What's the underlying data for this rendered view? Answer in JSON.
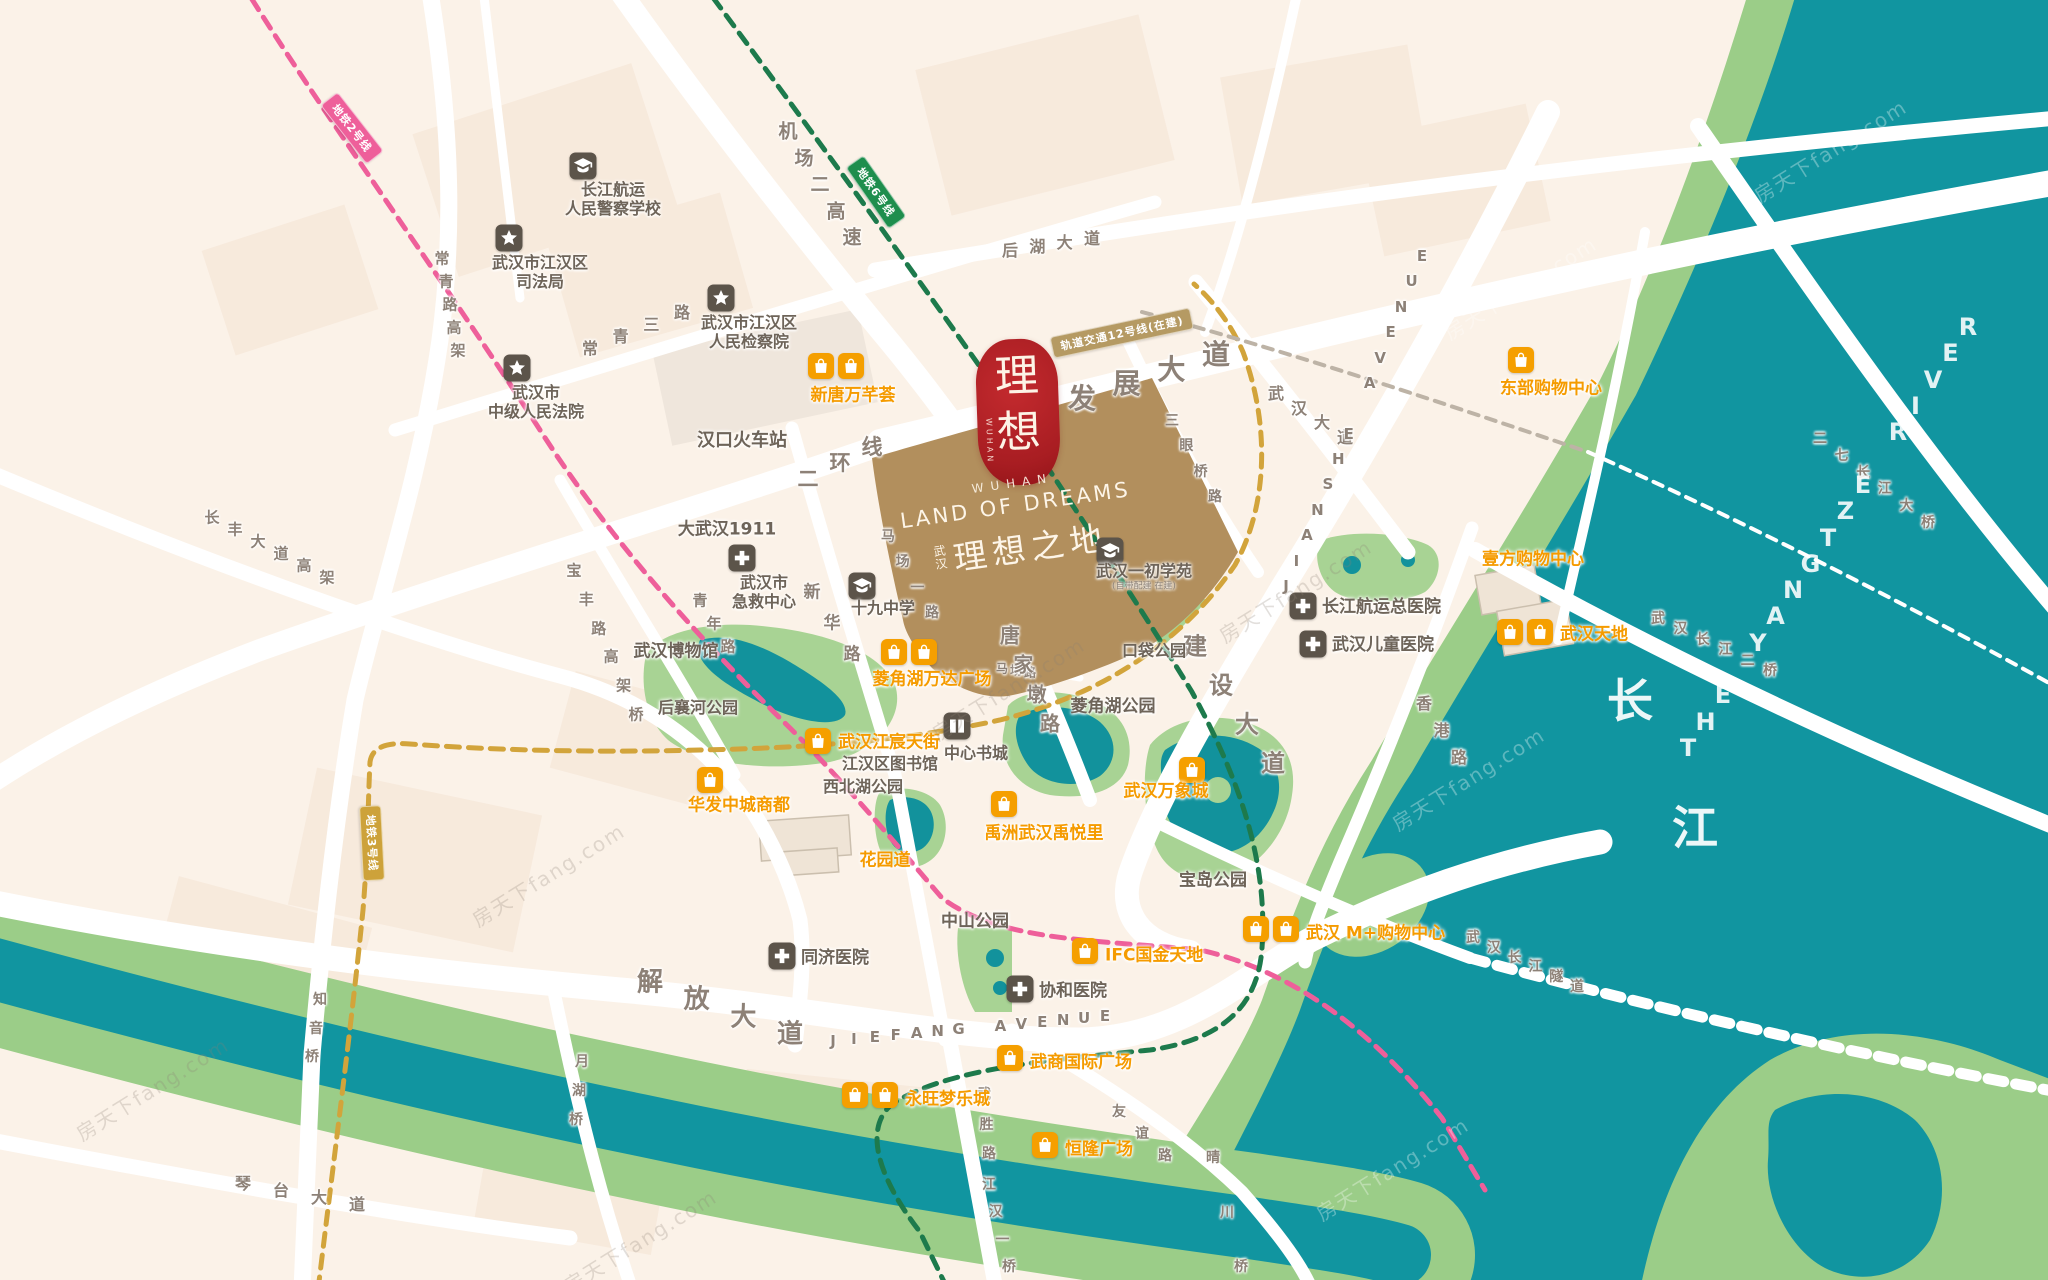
{
  "meta": {
    "title": "武汉理想之地 区位图",
    "width": 2048,
    "height": 1280
  },
  "colors": {
    "bg": "#fbf2e8",
    "water": "#1195a0",
    "bank": "#9bcd88",
    "park": "#a8d394",
    "road": "#ffffff",
    "project": "#b28f5d",
    "seal_red": "#a81d22",
    "orange": "#f59f00",
    "poi_gray": "#5c544a",
    "metro2_pink": "#ee5f9a",
    "metro3_gold": "#cda23a",
    "metro6_green": "#1e8e4d",
    "metro12_tan": "#b59a63"
  },
  "project": {
    "seal_top": "理",
    "seal_bottom": "想",
    "seal_side": "WUHAN",
    "en_small": "WUHAN",
    "en_title": "LAND OF DREAMS",
    "cn_prefix_1": "武",
    "cn_prefix_2": "汉",
    "cn_title": "理想之地"
  },
  "watermark_text": "房天下fang.com",
  "spread_labels": [
    [
      "机场二高速",
      788,
      130,
      852,
      236,
      19
    ],
    [
      "常青三路",
      590,
      347,
      682,
      311,
      16
    ],
    [
      "常青路高架",
      442,
      258,
      458,
      350,
      15
    ],
    [
      "长丰大道高架",
      212,
      517,
      327,
      577,
      15
    ],
    [
      "宝丰路高架桥",
      574,
      570,
      636,
      714,
      15
    ],
    [
      "青年路",
      700,
      600,
      728,
      646,
      15
    ],
    [
      "新华路",
      812,
      590,
      852,
      652,
      17
    ],
    [
      "马场一路",
      888,
      536,
      932,
      612,
      14
    ],
    [
      "马场路",
      1002,
      668,
      1030,
      672,
      12
    ],
    [
      "二环线",
      808,
      478,
      872,
      446,
      21
    ],
    [
      "发展大道",
      1082,
      397,
      1216,
      353,
      28
    ],
    [
      "后湖大道",
      1010,
      249,
      1092,
      237,
      16
    ],
    [
      "三眼桥路",
      1172,
      420,
      1215,
      496,
      14
    ],
    [
      "武汉大道",
      1276,
      392,
      1345,
      436,
      16
    ],
    [
      "建设大道",
      1195,
      644,
      1273,
      761,
      24
    ],
    [
      "香港路",
      1424,
      702,
      1459,
      756,
      16
    ],
    [
      "唐家墩路",
      1010,
      634,
      1050,
      722,
      20
    ],
    [
      "解放大道",
      650,
      980,
      790,
      1032,
      26
    ],
    [
      "JIEFANG AVENUE",
      833,
      1041,
      1105,
      1016,
      15
    ],
    [
      "JIANSHE AVENUE",
      1286,
      586,
      1422,
      256,
      15
    ],
    [
      "琴台大道",
      243,
      1182,
      357,
      1203,
      16
    ],
    [
      "武胜路",
      984,
      1094,
      989,
      1153,
      14
    ],
    [
      "江汉一桥",
      989,
      1184,
      1009,
      1266,
      14
    ],
    [
      "月湖桥",
      582,
      1061,
      576,
      1119,
      14
    ],
    [
      "知音桥",
      320,
      999,
      312,
      1056,
      14
    ],
    [
      "友谊路",
      1119,
      1111,
      1165,
      1155,
      14
    ],
    [
      "晴川桥",
      1213,
      1157,
      1241,
      1266,
      14
    ],
    [
      "二七长江大桥",
      1820,
      438,
      1928,
      522,
      14
    ],
    [
      "武汉长江二桥",
      1658,
      618,
      1770,
      670,
      14
    ],
    [
      "武汉长江隧道",
      1473,
      937,
      1577,
      986,
      14
    ],
    [
      "THE YANGTZE RIVER",
      1688,
      748,
      1968,
      327,
      24,
      "w"
    ]
  ],
  "poi_plain": [
    [
      "汉口火车站",
      742,
      439,
      18
    ],
    [
      "大武汉1911",
      727,
      527,
      17
    ],
    [
      "武汉博物馆",
      676,
      649,
      17
    ],
    [
      "后襄河公园",
      698,
      706,
      16
    ],
    [
      "江汉区图书馆",
      890,
      762,
      16
    ],
    [
      "西北湖公园",
      863,
      785,
      16
    ],
    [
      "口袋公园",
      1154,
      649,
      16
    ],
    [
      "菱角湖公园",
      1113,
      704,
      17
    ],
    [
      "宝岛公园",
      1213,
      878,
      17
    ],
    [
      "中山公园",
      975,
      919,
      17
    ],
    [
      "长",
      1630,
      698,
      46,
      "river"
    ],
    [
      "江",
      1695,
      825,
      46,
      "river"
    ]
  ],
  "poi_icons": [
    {
      "icon": "school",
      "ix": 583,
      "iy": 166,
      "lines": [
        "长江航运",
        "人民警察学校"
      ],
      "tx": 613,
      "ty": 200,
      "align": "c",
      "s": 16
    },
    {
      "icon": "star",
      "ix": 509,
      "iy": 238,
      "lines": [
        "武汉市江汉区",
        "司法局"
      ],
      "tx": 540,
      "ty": 273,
      "align": "c",
      "s": 16
    },
    {
      "icon": "star",
      "ix": 721,
      "iy": 298,
      "lines": [
        "武汉市江汉区",
        "人民检察院"
      ],
      "tx": 749,
      "ty": 333,
      "align": "c",
      "s": 16
    },
    {
      "icon": "star",
      "ix": 517,
      "iy": 368,
      "lines": [
        "武汉市",
        "中级人民法院"
      ],
      "tx": 536,
      "ty": 403,
      "align": "c",
      "s": 16
    },
    {
      "icon": "cross",
      "ix": 742,
      "iy": 558,
      "lines": [
        "武汉市",
        "急救中心"
      ],
      "tx": 764,
      "ty": 593,
      "align": "c",
      "s": 16
    },
    {
      "icon": "school",
      "ix": 862,
      "iy": 586,
      "lines": [
        "十九中学"
      ],
      "tx": 883,
      "ty": 609,
      "align": "c",
      "s": 16
    },
    {
      "icon": "school",
      "ix": 1110,
      "iy": 551,
      "lines": [
        "武汉一初学苑"
      ],
      "tx": 1144,
      "ty": 577,
      "align": "c",
      "s": 16,
      "sub": "(自带配建 在建)"
    },
    {
      "icon": "book",
      "ix": 957,
      "iy": 726,
      "lines": [
        "中心书城"
      ],
      "tx": 976,
      "ty": 754,
      "align": "c",
      "s": 16
    },
    {
      "icon": "cross",
      "ix": 1303,
      "iy": 606,
      "lines": [
        "长江航运总医院"
      ],
      "tx": 1322,
      "ty": 607,
      "align": "r",
      "s": 17
    },
    {
      "icon": "cross",
      "ix": 1313,
      "iy": 644,
      "lines": [
        "武汉儿童医院"
      ],
      "tx": 1332,
      "ty": 645,
      "align": "r",
      "s": 17
    },
    {
      "icon": "cross",
      "ix": 782,
      "iy": 956,
      "lines": [
        "同济医院"
      ],
      "tx": 801,
      "ty": 958,
      "align": "r",
      "s": 17
    },
    {
      "icon": "cross",
      "ix": 1020,
      "iy": 989,
      "lines": [
        "协和医院"
      ],
      "tx": 1039,
      "ty": 991,
      "align": "r",
      "s": 17
    }
  ],
  "malls": [
    {
      "t": "新唐万芊荟",
      "n": 2,
      "ix": 836,
      "iy": 366,
      "tx": 853,
      "ty": 393,
      "align": "c"
    },
    {
      "t": "菱角湖万达广场",
      "n": 2,
      "ix": 909,
      "iy": 652,
      "tx": 932,
      "ty": 677,
      "align": "c"
    },
    {
      "t": "东部购物中心",
      "n": 1,
      "ix": 1521,
      "iy": 360,
      "tx": 1551,
      "ty": 386,
      "align": "c"
    },
    {
      "t": "壹方购物中心",
      "n": 0,
      "tx": 1533,
      "ty": 557,
      "align": "c"
    },
    {
      "t": "武汉天地",
      "n": 2,
      "ix": 1525,
      "iy": 632,
      "tx": 1560,
      "ty": 632,
      "align": "r"
    },
    {
      "t": "武汉江宸天街",
      "n": 1,
      "ix": 818,
      "iy": 741,
      "tx": 838,
      "ty": 740,
      "align": "r"
    },
    {
      "t": "华发中城商都",
      "n": 1,
      "ix": 710,
      "iy": 780,
      "tx": 739,
      "ty": 803,
      "align": "c"
    },
    {
      "t": "花园道",
      "n": 0,
      "tx": 885,
      "ty": 858,
      "align": "c"
    },
    {
      "t": "禹洲武汉禹悦里",
      "n": 1,
      "ix": 1004,
      "iy": 804,
      "tx": 1044,
      "ty": 831,
      "align": "c"
    },
    {
      "t": "武汉万象城",
      "n": 1,
      "ix": 1192,
      "iy": 770,
      "tx": 1166,
      "ty": 789,
      "align": "c"
    },
    {
      "t": "武汉 M+购物中心",
      "n": 2,
      "ix": 1271,
      "iy": 929,
      "tx": 1306,
      "ty": 931,
      "align": "r"
    },
    {
      "t": "IFC国金天地",
      "n": 1,
      "ix": 1085,
      "iy": 951,
      "tx": 1105,
      "ty": 953,
      "align": "r"
    },
    {
      "t": "武商国际广场",
      "n": 1,
      "ix": 1010,
      "iy": 1058,
      "tx": 1030,
      "ty": 1060,
      "align": "r"
    },
    {
      "t": "恒隆广场",
      "n": 1,
      "ix": 1045,
      "iy": 1145,
      "tx": 1065,
      "ty": 1147,
      "align": "r"
    },
    {
      "t": "永旺梦乐城",
      "n": 2,
      "ix": 870,
      "iy": 1095,
      "tx": 905,
      "ty": 1097,
      "align": "r"
    }
  ],
  "metro_badges": [
    {
      "t": "地铁2号线",
      "x": 352,
      "y": 128,
      "r": 52,
      "bg": "#ee5f9a"
    },
    {
      "t": "地铁3号线",
      "x": 372,
      "y": 843,
      "r": 87,
      "bg": "#cda23a"
    },
    {
      "t": "地铁6号线",
      "x": 876,
      "y": 192,
      "r": 55,
      "bg": "#1e8e4d"
    },
    {
      "t": "轨道交通12号线(在建)",
      "x": 1122,
      "y": 333,
      "r": -12,
      "bg": "#b59a63"
    }
  ],
  "watermarks": [
    [
      1520,
      287,
      "l"
    ],
    [
      1295,
      590,
      "d"
    ],
    [
      1008,
      688,
      "d"
    ],
    [
      1468,
      778,
      "l"
    ],
    [
      548,
      874,
      "d"
    ],
    [
      1392,
      1168,
      "l"
    ],
    [
      152,
      1088,
      "d"
    ],
    [
      1830,
      150,
      "l"
    ],
    [
      640,
      1240,
      "d"
    ]
  ]
}
